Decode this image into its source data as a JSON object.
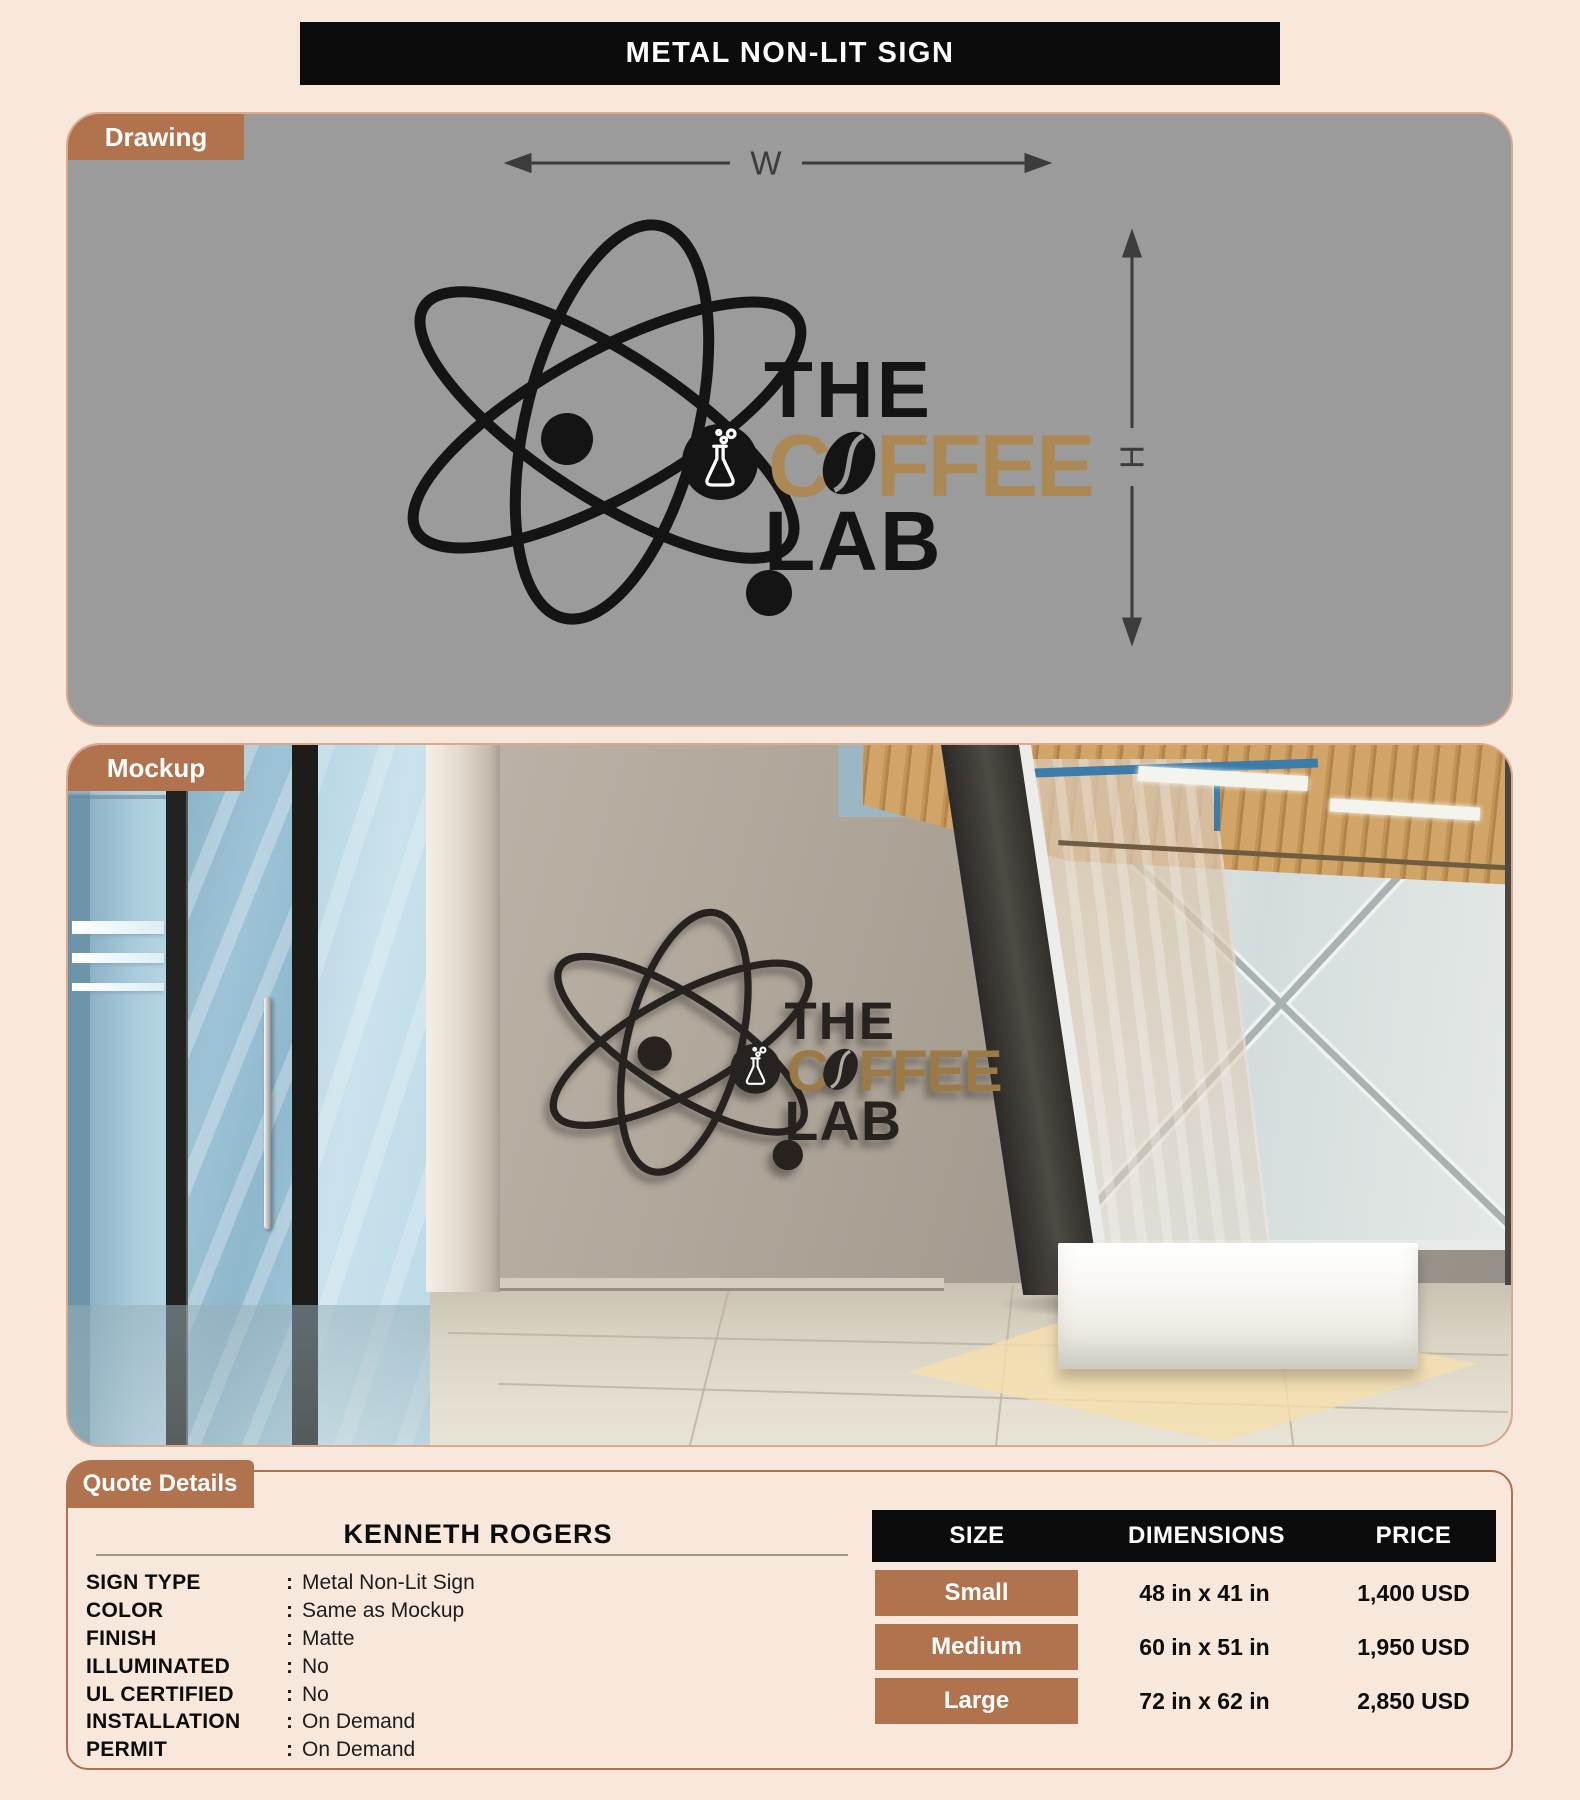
{
  "header": {
    "title": "METAL NON-LIT SIGN"
  },
  "sections": {
    "drawing_tab": "Drawing",
    "mockup_tab": "Mockup",
    "quote_tab": "Quote Details"
  },
  "drawing": {
    "width_label": "W",
    "height_label": "H"
  },
  "logo": {
    "the": "THE",
    "c": "C",
    "ffee": "FFEE",
    "lab": "LAB"
  },
  "quote": {
    "customer_name": "KENNETH ROGERS",
    "colon": ":",
    "fields": [
      {
        "label": "SIGN TYPE",
        "value": "Metal Non-Lit Sign"
      },
      {
        "label": "COLOR",
        "value": "Same as Mockup"
      },
      {
        "label": "FINISH",
        "value": "Matte"
      },
      {
        "label": "ILLUMINATED",
        "value": "No"
      },
      {
        "label": "UL CERTIFIED",
        "value": "No"
      },
      {
        "label": "INSTALLATION",
        "value": "On Demand"
      },
      {
        "label": "PERMIT",
        "value": "On Demand"
      }
    ],
    "pricing": {
      "headers": [
        "SIZE",
        "DIMENSIONS",
        "PRICE"
      ],
      "rows": [
        {
          "size": "Small",
          "dimensions": "48 in x 41 in",
          "price": "1,400 USD"
        },
        {
          "size": "Medium",
          "dimensions": "60 in x 51 in",
          "price": "1,950 USD"
        },
        {
          "size": "Large",
          "dimensions": "72 in x 62 in",
          "price": "2,850 USD"
        }
      ]
    }
  },
  "colors": {
    "accent_brown": "#b1734d",
    "header_black": "#0c0c0c",
    "drawing_gray": "#9b9b9b",
    "page_cream": "#f8e7db",
    "logo_tan": "#ac8954"
  }
}
